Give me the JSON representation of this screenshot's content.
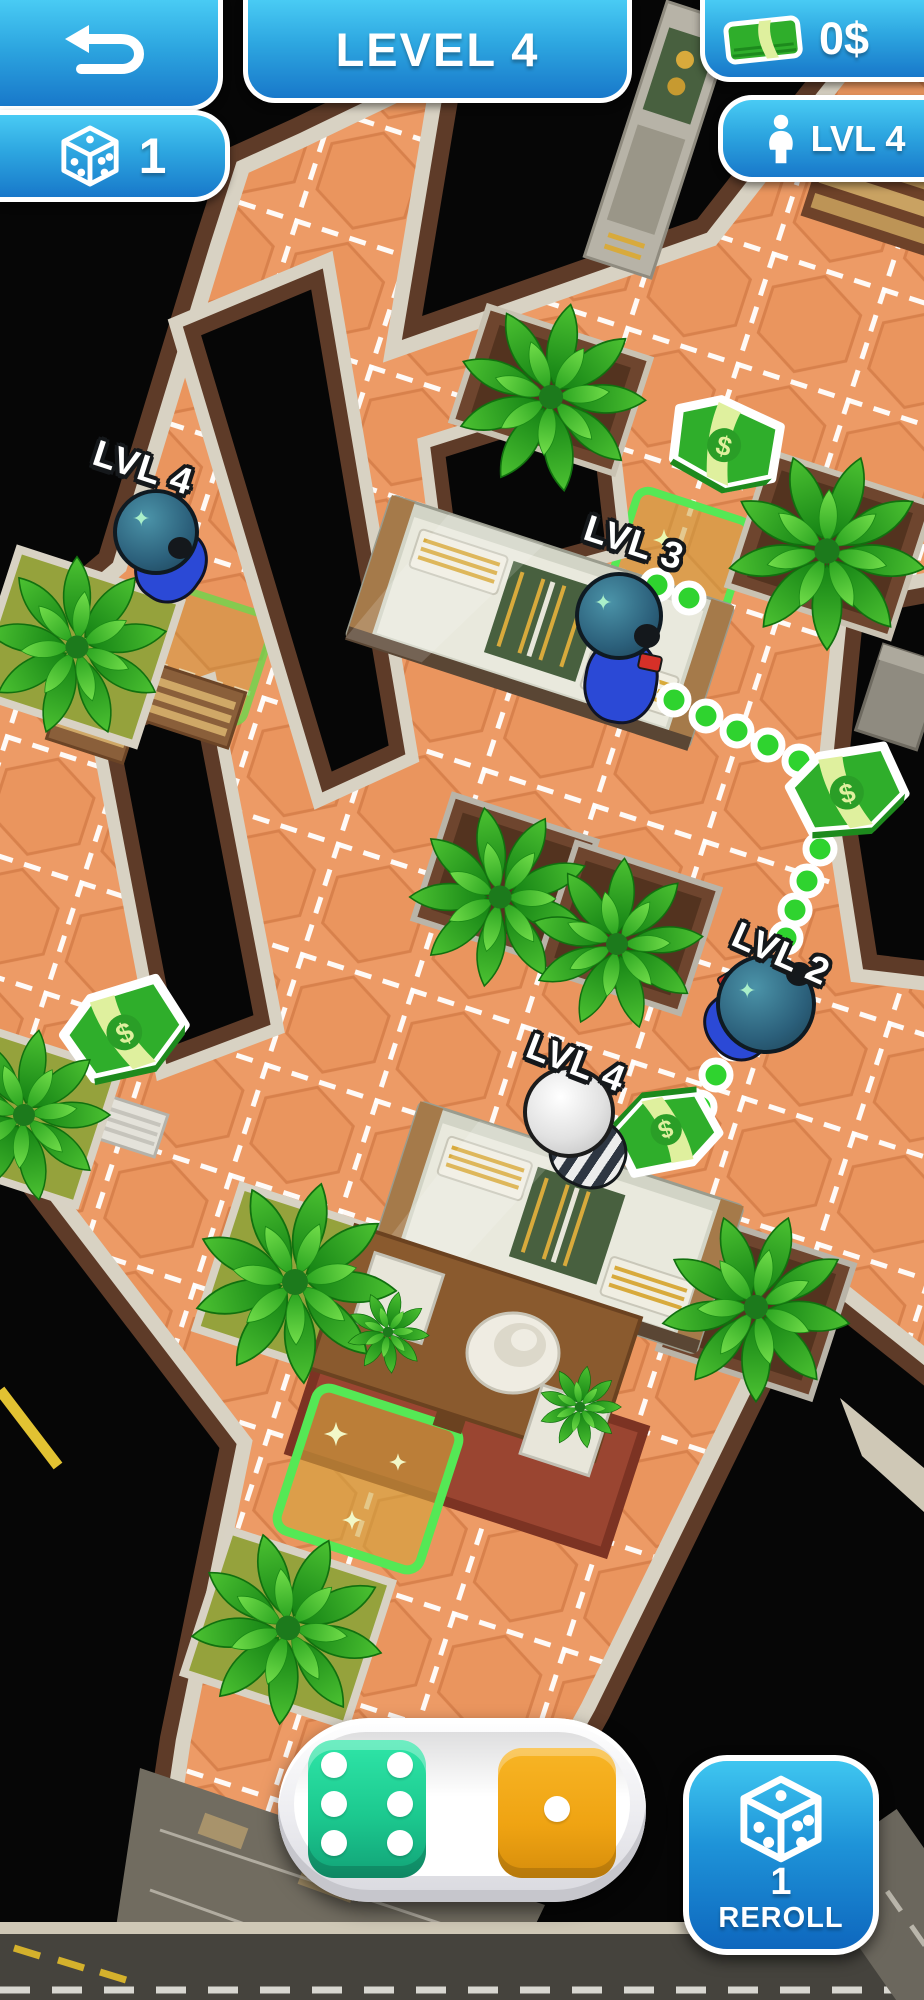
{
  "hud": {
    "level_banner": {
      "label": "LEVEL 4"
    },
    "money_counter": {
      "value": "0$"
    },
    "dice_counter": {
      "value": "1"
    },
    "player_level": {
      "label": "LVL 4"
    }
  },
  "characters": [
    {
      "id": "police-1",
      "type": "police",
      "label": "LVL 4"
    },
    {
      "id": "police-2",
      "type": "police",
      "label": "LVL 3"
    },
    {
      "id": "police-3",
      "type": "police",
      "label": "LVL 2"
    },
    {
      "id": "prisoner",
      "type": "prisoner",
      "label": "LVL 4"
    }
  ],
  "dice_tray": {
    "dice": [
      {
        "color": "teal",
        "value": 6
      },
      {
        "color": "orange",
        "value": 1
      }
    ]
  },
  "reroll": {
    "count": "1",
    "label": "REROLL"
  },
  "colors": {
    "hud_blue_top": "#49cbf4",
    "hud_blue_bottom": "#1878ca",
    "floor_orange": "#ed9b66",
    "path_green": "#2fd32f",
    "die_teal": "#1cc98f",
    "die_orange": "#efa312",
    "highlight_green": "#55e855",
    "money_green": "#2fae2b"
  }
}
